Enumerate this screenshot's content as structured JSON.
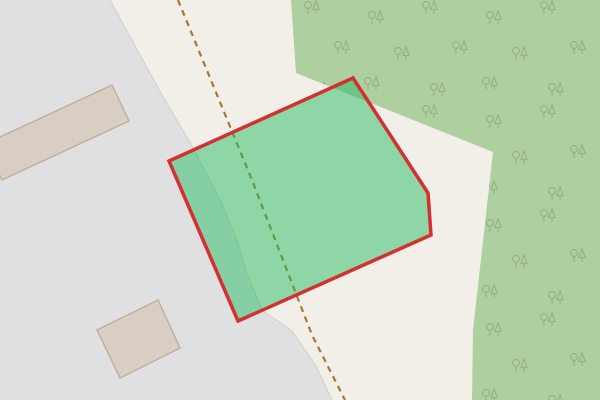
{
  "map": {
    "width": 600,
    "height": 400,
    "land_color": "#f2efe9",
    "features": {
      "paved_area": {
        "fill": "#e0e0e3",
        "edge_color": "#d0cfca",
        "edge_width": 1,
        "points": "0,0 110,0 162,95 192,146 220,200 237,240 245,268 262,310 292,331 316,366 332,400 0,400",
        "edge_points": "110,0 162,95 192,146 220,200 237,240 245,268 262,310 292,331 316,366 332,400"
      },
      "forest": {
        "fill": "#aecfa0",
        "points": "291,0 600,0 600,400 472,400 473,330 482,250 493,152 296,73",
        "trees": {
          "color": "#96b287",
          "stroke_width": 1.2,
          "tile_width": 118,
          "tile_height": 104,
          "positions": [
            [
              18,
              22
            ],
            [
              72,
              12
            ],
            [
              102,
              52
            ],
            [
              44,
              58
            ],
            [
              14,
              88
            ],
            [
              80,
              94
            ]
          ]
        }
      },
      "buildings": {
        "fill": "#d9cec3",
        "stroke": "#bfad99",
        "stroke_width": 1.4,
        "footprints": [
          "-15,144 112,85 129,121 2,180",
          "158,300 180,348 120,378 97,330"
        ]
      },
      "track": {
        "color": "#a97634",
        "width": 2.2,
        "dash": "6 5",
        "points": "178,0 252,180 312,335 345,400"
      },
      "selected_parcel": {
        "stroke": "#d43030",
        "stroke_width": 3.5,
        "fill": "#23b95f",
        "fill_opacity": 0.48,
        "points": "169,161 353,78 428,193 431,235 238,321"
      }
    }
  }
}
